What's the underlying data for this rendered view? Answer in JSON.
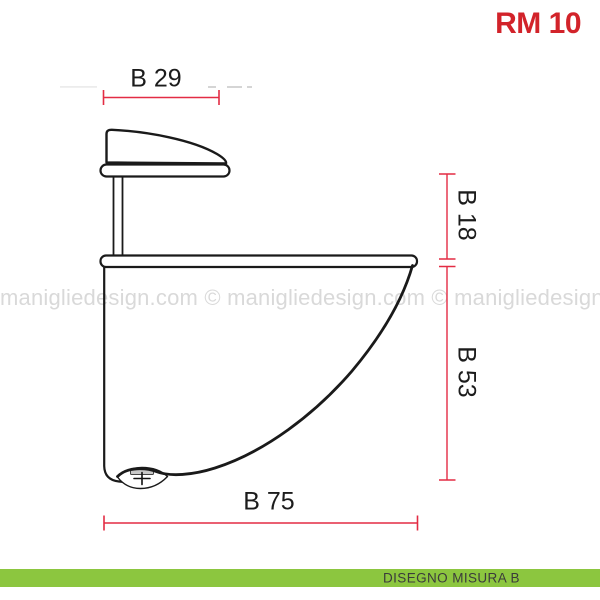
{
  "page": {
    "title": "RM 10"
  },
  "colors": {
    "title_red": "#d2232a",
    "dimension_red": "#e32c44",
    "drawing_black": "#1a1a1a",
    "watermark_gray": "#d9d9d9",
    "footer_green": "#8cc63f",
    "footer_text": "#3b3b3b",
    "label_black": "#1c1c1c"
  },
  "watermark": {
    "text": "manigliedesign.com © manigliedesign.com © manigliedesign.com ©"
  },
  "drawing": {
    "description": "shelf-bracket-side-view"
  },
  "dimensions": {
    "b29": {
      "label": "B 29",
      "orientation": "horizontal"
    },
    "b18": {
      "label": "B 18",
      "orientation": "vertical"
    },
    "b53": {
      "label": "B 53",
      "orientation": "vertical"
    },
    "b75": {
      "label": "B 75",
      "orientation": "horizontal"
    }
  },
  "footer": {
    "label": "DISEGNO MISURA B"
  }
}
